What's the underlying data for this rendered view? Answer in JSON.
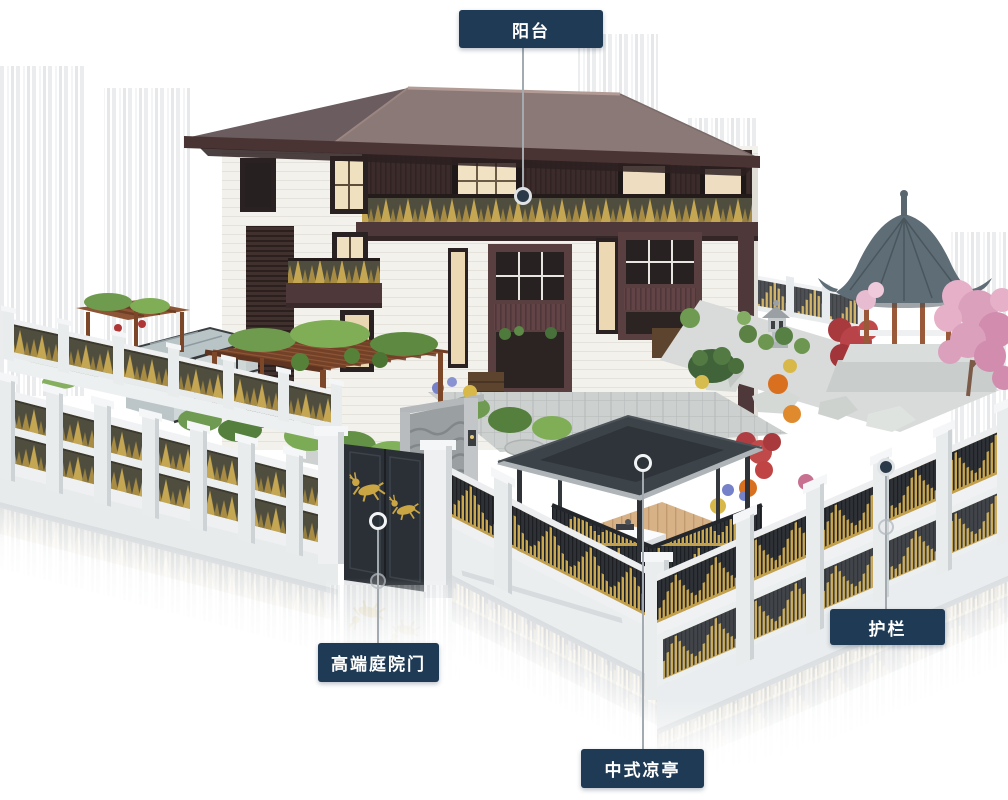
{
  "page": {
    "width": 1008,
    "height": 800,
    "background": "#ffffff",
    "kind": "annotated-architectural-render"
  },
  "colors": {
    "label_bg": "#1e3a55",
    "label_text": "#ffffff",
    "connector": "#a4abb0",
    "marker_ring": "#e9ecee",
    "marker_fill": "#2b3a48",
    "accent_gold": "#c3a04c",
    "roof": "#8a7976",
    "dark_wood": "#3b2c2b",
    "fence_panel": "#4f4d3e",
    "white_wall": "#f3f1ec"
  },
  "callouts": [
    {
      "id": "balcony",
      "label": "阳台",
      "box": {
        "left": 459,
        "top": 10,
        "width": 144,
        "height": 38
      },
      "line": {
        "x": 523,
        "y1": 48,
        "y2": 188
      },
      "marker": {
        "x": 523,
        "y": 196,
        "r": 9,
        "style": "filled"
      },
      "ghost": null
    },
    {
      "id": "premium-courtyard-gate",
      "label": "高端庭院门",
      "box": {
        "left": 318,
        "top": 643,
        "width": 121,
        "height": 39
      },
      "line": {
        "x": 378,
        "y1": 530,
        "y2": 643
      },
      "marker": {
        "x": 378,
        "y": 521,
        "r": 9,
        "style": "ring"
      },
      "ghost": {
        "x": 378,
        "y": 581,
        "r": 8
      }
    },
    {
      "id": "chinese-pavilion",
      "label": "中式凉亭",
      "box": {
        "left": 581,
        "top": 749,
        "width": 123,
        "height": 39
      },
      "line": {
        "x": 643,
        "y1": 472,
        "y2": 749
      },
      "marker": {
        "x": 643,
        "y": 463,
        "r": 9,
        "style": "ring"
      },
      "ghost": null
    },
    {
      "id": "guardrail",
      "label": "护栏",
      "box": {
        "left": 830,
        "top": 609,
        "width": 115,
        "height": 36
      },
      "line": {
        "x": 886,
        "y1": 476,
        "y2": 609
      },
      "marker": {
        "x": 886,
        "y": 467,
        "r": 9,
        "style": "filled"
      },
      "ghost": {
        "x": 886,
        "y": 527,
        "r": 8
      }
    }
  ],
  "scene": {
    "parts": [
      "hip-roof",
      "balcony-railing",
      "louver-screen",
      "courtyard-gate",
      "gate-deer-motif",
      "left-fence",
      "front-fence",
      "right-fence",
      "back-fence",
      "chinese-gazebo",
      "cherry-blossom-tree",
      "rock-garden",
      "stone-lantern",
      "flat-roof-pavilion",
      "wood-deck",
      "tea-table",
      "pergola",
      "greenhouse",
      "garden-hedge",
      "water-ripple-screen-wall",
      "stone-paving",
      "floor-reflection"
    ]
  }
}
